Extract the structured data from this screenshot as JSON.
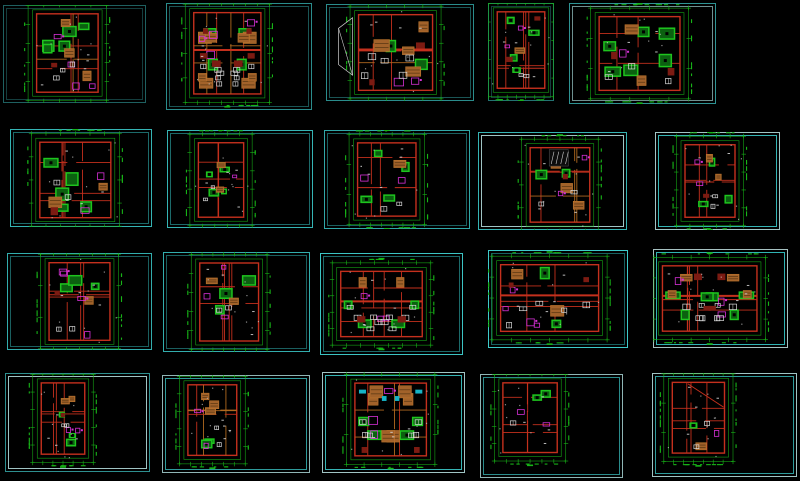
{
  "canvas": {
    "width": 800,
    "height": 481,
    "background": "#000000"
  },
  "palette": {
    "dim_green": "#17b517",
    "wall_red": "#c4301d",
    "wall_orange": "#b0691f",
    "fill_orange": "#a2622a",
    "fill_orange_dark": "#5f3a14",
    "fill_orange_edge": "#c47a2e",
    "furn_green": "#1ec41e",
    "furn_green_dark": "#0b6110",
    "magenta": "#d630d6",
    "white": "#d9d9d9",
    "dark_red": "#7c1b12",
    "cyan_accent": "#16b4c6",
    "frame_bright": "#35b4b4",
    "frame_dim": "#1c6a6a",
    "frame_pale": "#9fc4c4"
  },
  "cells": [
    {
      "id": "r1c1",
      "x": 3,
      "y": 5,
      "w": 143,
      "h": 98,
      "outer": "#1e6060",
      "inner": "#143e3e",
      "plan": {
        "cx": 0.45,
        "cy": 0.49,
        "w": 0.43,
        "h": 0.8
      },
      "style": {
        "seed": 101,
        "mixed": true,
        "band": false,
        "mirror": false,
        "stairs": false,
        "diag": "",
        "counts": {
          "green": 5,
          "orange": 3,
          "magenta": 4,
          "white": 3,
          "dred": 1,
          "cyan": 0
        }
      }
    },
    {
      "id": "r1c2",
      "x": 166,
      "y": 3,
      "w": 146,
      "h": 107,
      "outer": "#2a8c8c",
      "inner": "#1a5555",
      "plan": {
        "cx": 0.42,
        "cy": 0.47,
        "w": 0.46,
        "h": 0.76
      },
      "style": {
        "seed": 102,
        "mixed": true,
        "band": true,
        "mirror": true,
        "stairs": false,
        "diag": "",
        "counts": {
          "green": 2,
          "orange": 4,
          "magenta": 4,
          "white": 5,
          "dred": 3,
          "cyan": 0
        }
      }
    },
    {
      "id": "r1c3",
      "x": 326,
      "y": 4,
      "w": 148,
      "h": 97,
      "outer": "#2a8c8c",
      "inner": "#1a5555",
      "plan": {
        "cx": 0.47,
        "cy": 0.5,
        "w": 0.5,
        "h": 0.78
      },
      "style": {
        "seed": 103,
        "mixed": true,
        "band": true,
        "mirror": false,
        "stairs": false,
        "diag": "left",
        "counts": {
          "green": 2,
          "orange": 4,
          "magenta": 2,
          "white": 5,
          "dred": 2,
          "cyan": 0
        }
      }
    },
    {
      "id": "r1c4",
      "x": 488,
      "y": 3,
      "w": 66,
      "h": 98,
      "outer": "#237272",
      "inner": "#143e3e",
      "plan": {
        "cx": 0.5,
        "cy": 0.48,
        "w": 0.72,
        "h": 0.78
      },
      "style": {
        "seed": 104,
        "mixed": false,
        "band": false,
        "mirror": false,
        "stairs": false,
        "diag": "",
        "counts": {
          "green": 4,
          "orange": 1,
          "magenta": 2,
          "white": 2,
          "dred": 2,
          "cyan": 0
        }
      }
    },
    {
      "id": "r1c5",
      "x": 569,
      "y": 3,
      "w": 147,
      "h": 101,
      "outer": "#2e9393",
      "inner": "#6e9090",
      "plan": {
        "cx": 0.48,
        "cy": 0.5,
        "w": 0.55,
        "h": 0.73
      },
      "style": {
        "seed": 105,
        "mixed": false,
        "band": false,
        "mirror": false,
        "stairs": false,
        "diag": "",
        "counts": {
          "green": 6,
          "orange": 2,
          "magenta": 1,
          "white": 3,
          "dred": 2,
          "cyan": 0
        }
      }
    },
    {
      "id": "r2c1",
      "x": 10,
      "y": 129,
      "w": 142,
      "h": 98,
      "outer": "#35b4b4",
      "inner": "#1c6a6a",
      "plan": {
        "cx": 0.46,
        "cy": 0.52,
        "w": 0.5,
        "h": 0.77
      },
      "style": {
        "seed": 201,
        "mixed": false,
        "band": false,
        "mirror": false,
        "stairs": false,
        "diag": "",
        "counts": {
          "green": 5,
          "orange": 2,
          "magenta": 2,
          "white": 2,
          "dred": 1,
          "cyan": 0
        }
      }
    },
    {
      "id": "r2c2",
      "x": 167,
      "y": 130,
      "w": 146,
      "h": 98,
      "outer": "#35b4b4",
      "inner": "#1c6a6a",
      "plan": {
        "cx": 0.37,
        "cy": 0.51,
        "w": 0.31,
        "h": 0.76
      },
      "style": {
        "seed": 202,
        "mixed": true,
        "band": false,
        "mirror": false,
        "stairs": false,
        "diag": "",
        "counts": {
          "green": 4,
          "orange": 2,
          "magenta": 1,
          "white": 2,
          "dred": 0,
          "cyan": 0
        }
      }
    },
    {
      "id": "r2c3",
      "x": 324,
      "y": 130,
      "w": 146,
      "h": 99,
      "outer": "#30a8a8",
      "inner": "#1a5f5f",
      "plan": {
        "cx": 0.43,
        "cy": 0.5,
        "w": 0.4,
        "h": 0.74
      },
      "style": {
        "seed": 203,
        "mixed": false,
        "band": false,
        "mirror": false,
        "stairs": false,
        "diag": "",
        "counts": {
          "green": 4,
          "orange": 1,
          "magenta": 2,
          "white": 2,
          "dred": 0,
          "cyan": 0
        }
      }
    },
    {
      "id": "r2c4",
      "x": 478,
      "y": 132,
      "w": 149,
      "h": 98,
      "outer": "#35b4b4",
      "inner": "#9fc4c4",
      "plan": {
        "cx": 0.55,
        "cy": 0.54,
        "w": 0.4,
        "h": 0.76
      },
      "style": {
        "seed": 204,
        "mixed": true,
        "band": false,
        "mirror": false,
        "stairs": true,
        "diag": "",
        "counts": {
          "green": 2,
          "orange": 3,
          "magenta": 2,
          "white": 2,
          "dred": 1,
          "cyan": 0
        }
      }
    },
    {
      "id": "r2c5",
      "x": 655,
      "y": 132,
      "w": 125,
      "h": 98,
      "outer": "#9fc4c4",
      "inner": "#35b4b4",
      "plan": {
        "cx": 0.44,
        "cy": 0.5,
        "w": 0.4,
        "h": 0.74
      },
      "style": {
        "seed": 205,
        "mixed": false,
        "band": false,
        "mirror": false,
        "stairs": false,
        "diag": "",
        "counts": {
          "green": 3,
          "orange": 2,
          "magenta": 2,
          "white": 2,
          "dred": 1,
          "cyan": 0
        }
      }
    },
    {
      "id": "r3c1",
      "x": 7,
      "y": 253,
      "w": 145,
      "h": 97,
      "outer": "#32adad",
      "inner": "#1a5f5f",
      "plan": {
        "cx": 0.5,
        "cy": 0.5,
        "w": 0.42,
        "h": 0.8
      },
      "style": {
        "seed": 301,
        "mixed": false,
        "band": false,
        "mirror": false,
        "stairs": false,
        "diag": "",
        "counts": {
          "green": 3,
          "orange": 1,
          "magenta": 4,
          "white": 2,
          "dred": 1,
          "cyan": 0
        }
      }
    },
    {
      "id": "r3c2",
      "x": 163,
      "y": 252,
      "w": 147,
      "h": 100,
      "outer": "#32adad",
      "inner": "#1a5f5f",
      "plan": {
        "cx": 0.45,
        "cy": 0.5,
        "w": 0.4,
        "h": 0.78
      },
      "style": {
        "seed": 302,
        "mixed": false,
        "band": false,
        "mirror": false,
        "stairs": false,
        "diag": "",
        "counts": {
          "green": 3,
          "orange": 2,
          "magenta": 3,
          "white": 2,
          "dred": 0,
          "cyan": 0
        }
      }
    },
    {
      "id": "r3c3",
      "x": 320,
      "y": 253,
      "w": 143,
      "h": 102,
      "outer": "#3cc4c4",
      "inner": "#1c6a6a",
      "plan": {
        "cx": 0.43,
        "cy": 0.5,
        "w": 0.57,
        "h": 0.64
      },
      "style": {
        "seed": 303,
        "mixed": false,
        "band": true,
        "mirror": true,
        "stairs": false,
        "diag": "",
        "counts": {
          "green": 2,
          "orange": 1,
          "magenta": 3,
          "white": 5,
          "dred": 1,
          "cyan": 0
        }
      }
    },
    {
      "id": "r3c4",
      "x": 488,
      "y": 250,
      "w": 140,
      "h": 98,
      "outer": "#3ecaca",
      "inner": "#17605f",
      "plan": {
        "cx": 0.44,
        "cy": 0.49,
        "w": 0.7,
        "h": 0.68
      },
      "style": {
        "seed": 304,
        "mixed": false,
        "band": true,
        "mirror": false,
        "stairs": false,
        "diag": "",
        "counts": {
          "green": 2,
          "orange": 2,
          "magenta": 4,
          "white": 5,
          "dred": 2,
          "cyan": 0
        }
      }
    },
    {
      "id": "r3c5",
      "x": 653,
      "y": 249,
      "w": 135,
      "h": 99,
      "outer": "#a6c1c1",
      "inner": "#2fb3b3",
      "plan": {
        "cx": 0.42,
        "cy": 0.5,
        "w": 0.7,
        "h": 0.66
      },
      "style": {
        "seed": 305,
        "mixed": false,
        "band": true,
        "mirror": true,
        "stairs": false,
        "diag": "",
        "counts": {
          "green": 3,
          "orange": 2,
          "magenta": 3,
          "white": 4,
          "dred": 2,
          "cyan": 0
        }
      }
    },
    {
      "id": "r4c1",
      "x": 5,
      "y": 373,
      "w": 145,
      "h": 99,
      "outer": "#2e8f8f",
      "inner": "#9fc4c4",
      "plan": {
        "cx": 0.4,
        "cy": 0.46,
        "w": 0.3,
        "h": 0.72
      },
      "style": {
        "seed": 401,
        "mixed": false,
        "band": false,
        "mirror": false,
        "stairs": false,
        "diag": "",
        "counts": {
          "green": 3,
          "orange": 2,
          "magenta": 2,
          "white": 2,
          "dred": 1,
          "cyan": 0
        }
      }
    },
    {
      "id": "r4c2",
      "x": 162,
      "y": 375,
      "w": 148,
      "h": 98,
      "outer": "#8fb5b5",
      "inner": "#2e9b9b",
      "plan": {
        "cx": 0.34,
        "cy": 0.46,
        "w": 0.33,
        "h": 0.72
      },
      "style": {
        "seed": 402,
        "mixed": true,
        "band": false,
        "mirror": false,
        "stairs": false,
        "diag": "",
        "counts": {
          "green": 2,
          "orange": 3,
          "magenta": 2,
          "white": 2,
          "dred": 0,
          "cyan": 0
        }
      }
    },
    {
      "id": "r4c3",
      "x": 322,
      "y": 372,
      "w": 143,
      "h": 101,
      "outer": "#9fc4c4",
      "inner": "#35b4b4",
      "plan": {
        "cx": 0.48,
        "cy": 0.47,
        "w": 0.5,
        "h": 0.72
      },
      "style": {
        "seed": 403,
        "mixed": true,
        "band": false,
        "mirror": true,
        "stairs": false,
        "diag": "",
        "counts": {
          "green": 2,
          "orange": 3,
          "magenta": 3,
          "white": 3,
          "dred": 1,
          "cyan": 2
        }
      }
    },
    {
      "id": "r4c4",
      "x": 480,
      "y": 374,
      "w": 143,
      "h": 104,
      "outer": "#8fb5b5",
      "inner": "#2a8c8c",
      "plan": {
        "cx": 0.35,
        "cy": 0.42,
        "w": 0.38,
        "h": 0.67
      },
      "style": {
        "seed": 404,
        "mixed": false,
        "band": false,
        "mirror": false,
        "stairs": false,
        "diag": "",
        "counts": {
          "green": 2,
          "orange": 0,
          "magenta": 2,
          "white": 1,
          "dred": 0,
          "cyan": 0
        }
      }
    },
    {
      "id": "r4c5",
      "x": 652,
      "y": 373,
      "w": 145,
      "h": 104,
      "outer": "#9fc4c4",
      "inner": "#2e9b9b",
      "plan": {
        "cx": 0.32,
        "cy": 0.43,
        "w": 0.36,
        "h": 0.68
      },
      "style": {
        "seed": 405,
        "mixed": false,
        "band": false,
        "mirror": false,
        "stairs": false,
        "diag": "inner",
        "counts": {
          "green": 1,
          "orange": 1,
          "magenta": 1,
          "white": 2,
          "dred": 0,
          "cyan": 0
        }
      }
    }
  ]
}
